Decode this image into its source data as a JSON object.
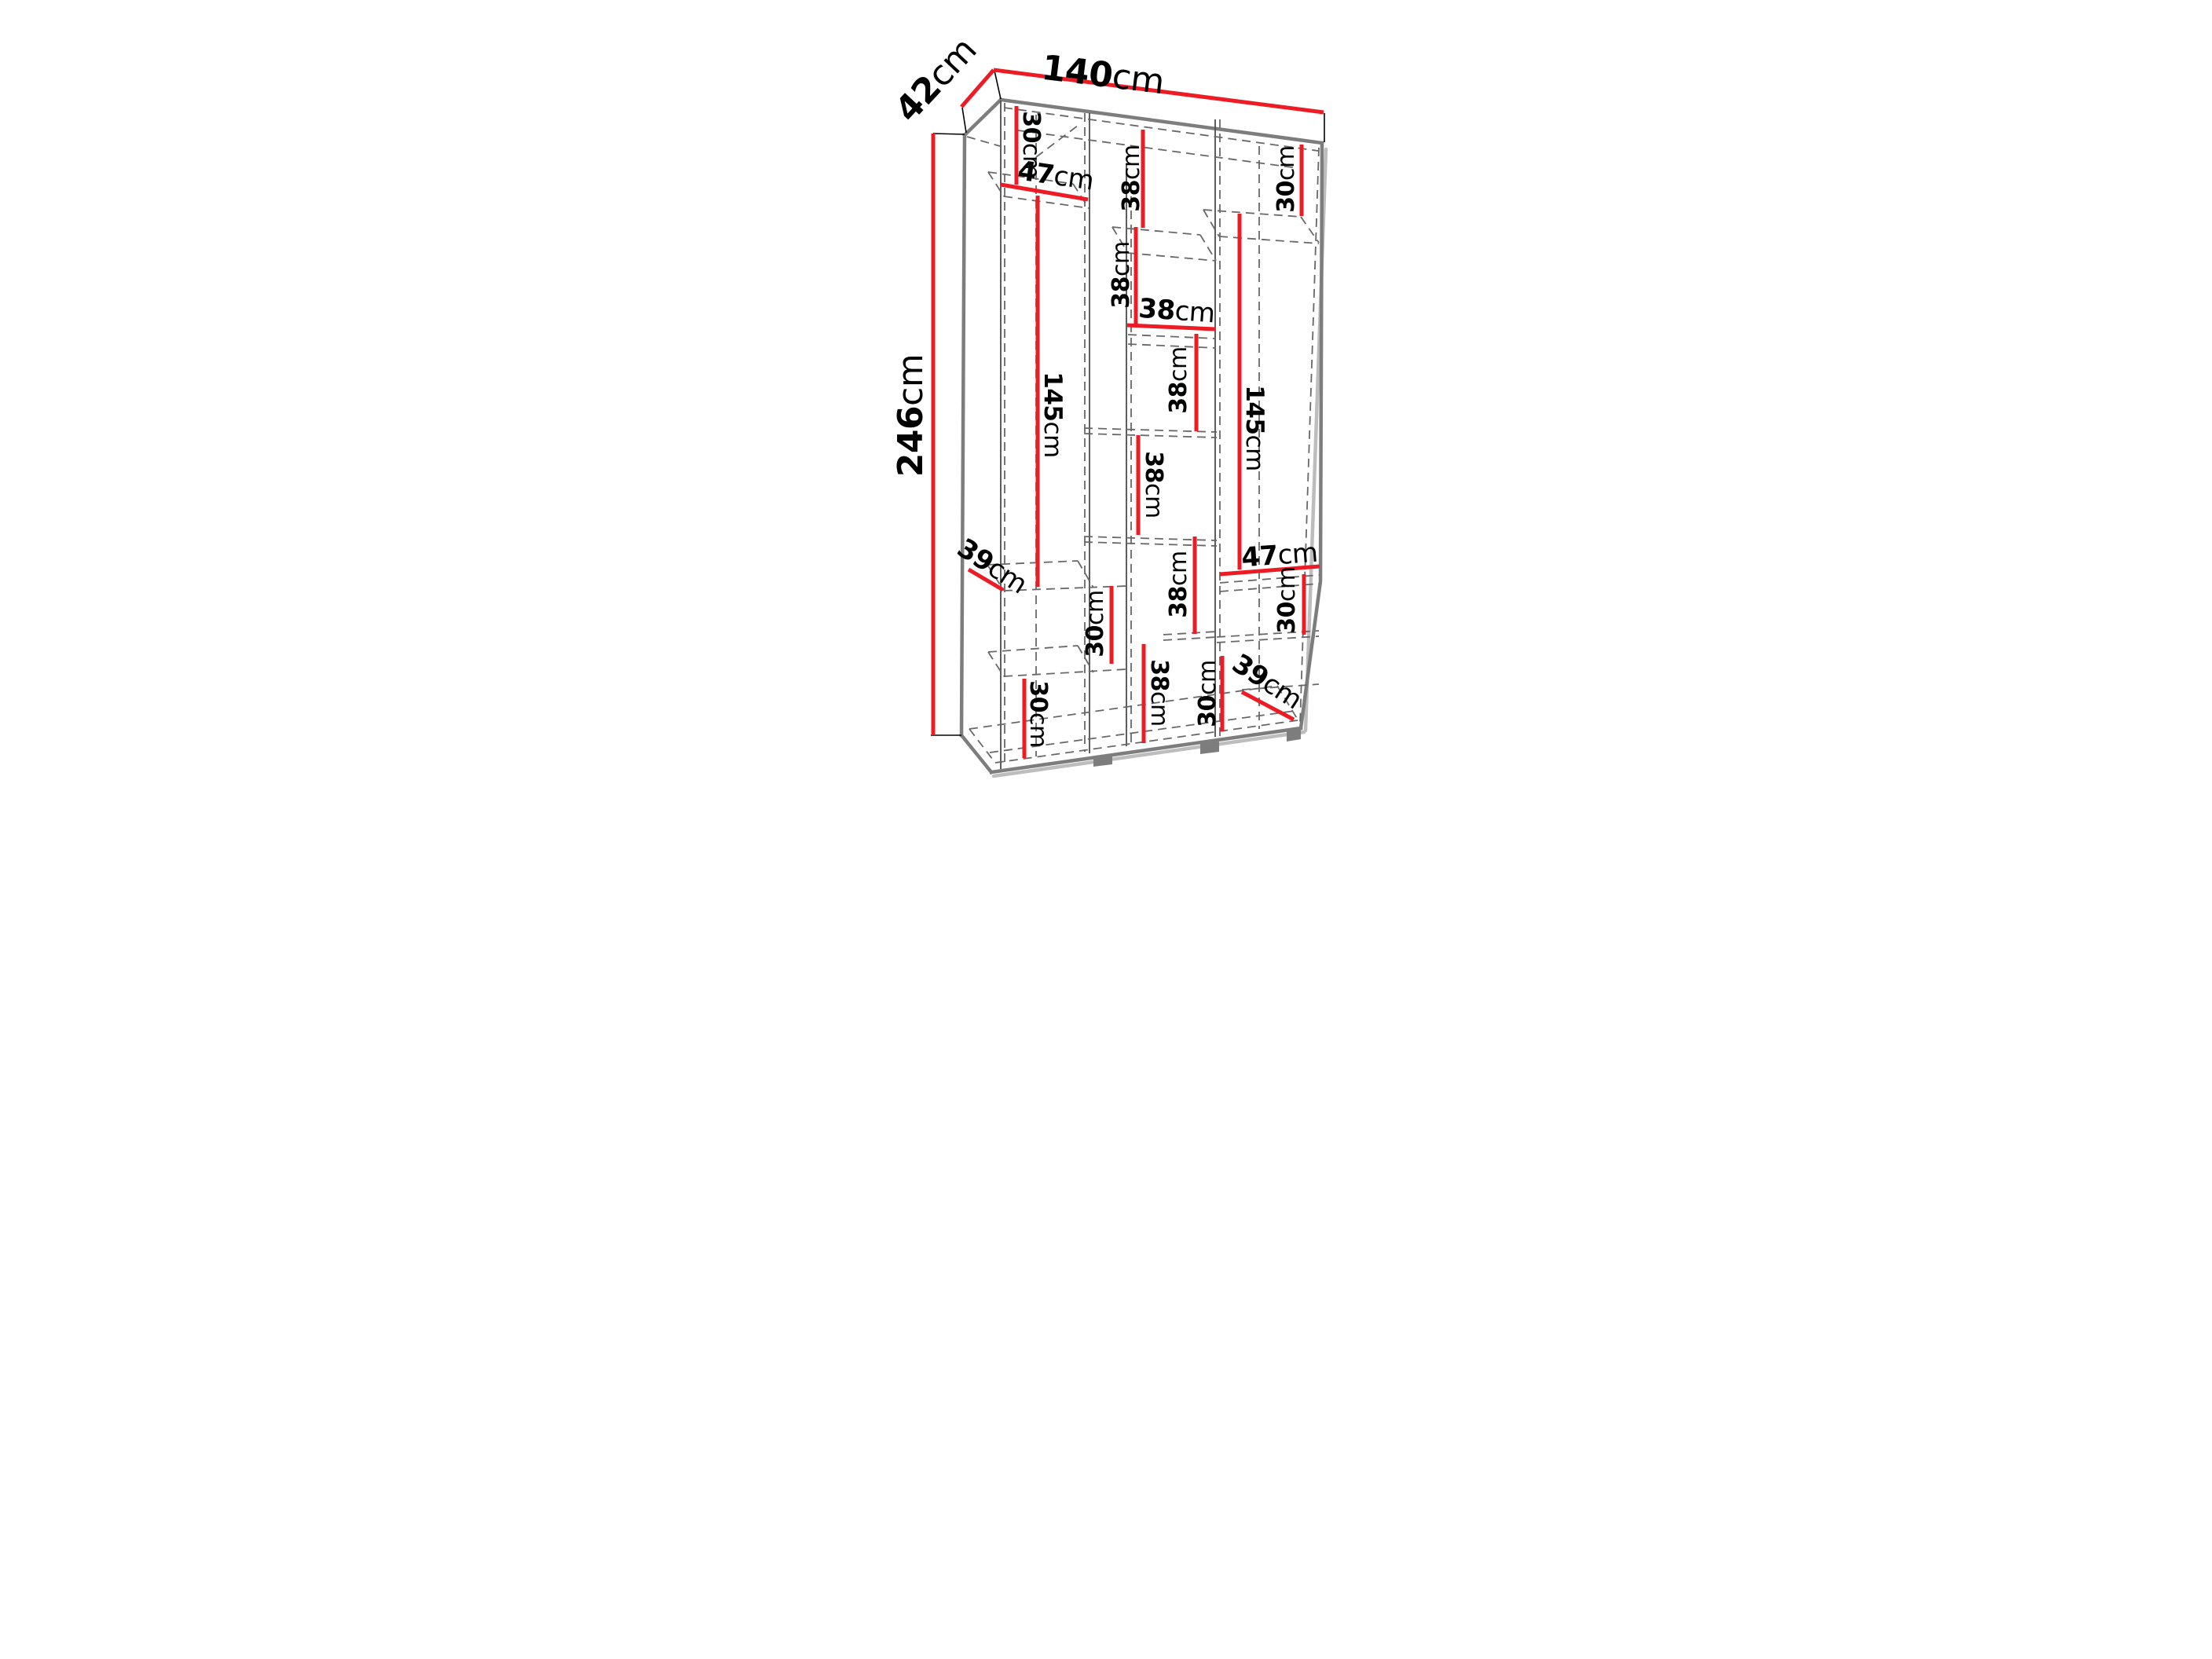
{
  "title": "Wardrobe dimension diagram",
  "unit": "cm",
  "colors": {
    "dimension_line": "#ed1c24",
    "outline": "#7d7d7d",
    "hidden_edge": "#686868",
    "label_text": "#000000",
    "background": "#ffffff"
  },
  "overall": {
    "width_cm": 140,
    "depth_cm": 42,
    "height_cm": 246
  },
  "labels": {
    "depth_top": {
      "num": "42",
      "unit": "cm"
    },
    "width_top": {
      "num": "140",
      "unit": "cm"
    },
    "height_left": {
      "num": "246",
      "unit": "cm"
    },
    "left_top_section": {
      "num": "30",
      "unit": "cm"
    },
    "left_shelf_width": {
      "num": "47",
      "unit": "cm"
    },
    "mid_section_1": {
      "num": "38",
      "unit": "cm"
    },
    "right_top_section": {
      "num": "30",
      "unit": "cm"
    },
    "mid_section_2": {
      "num": "38",
      "unit": "cm"
    },
    "mid_shelf_width": {
      "num": "38",
      "unit": "cm"
    },
    "left_tall_section": {
      "num": "145",
      "unit": "cm"
    },
    "mid_section_3": {
      "num": "38",
      "unit": "cm"
    },
    "right_tall_section": {
      "num": "145",
      "unit": "cm"
    },
    "mid_section_4": {
      "num": "38",
      "unit": "cm"
    },
    "left_shelf_depth": {
      "num": "39",
      "unit": "cm"
    },
    "right_shelf_width": {
      "num": "47",
      "unit": "cm"
    },
    "left_mid_section": {
      "num": "30",
      "unit": "cm"
    },
    "mid_section_5": {
      "num": "38",
      "unit": "cm"
    },
    "right_mid_section": {
      "num": "30",
      "unit": "cm"
    },
    "mid_bottom_section": {
      "num": "38",
      "unit": "cm"
    },
    "right_bottom_section": {
      "num": "30",
      "unit": "cm"
    },
    "left_bottom_section": {
      "num": "30",
      "unit": "cm"
    },
    "right_shelf_depth": {
      "num": "39",
      "unit": "cm"
    }
  }
}
